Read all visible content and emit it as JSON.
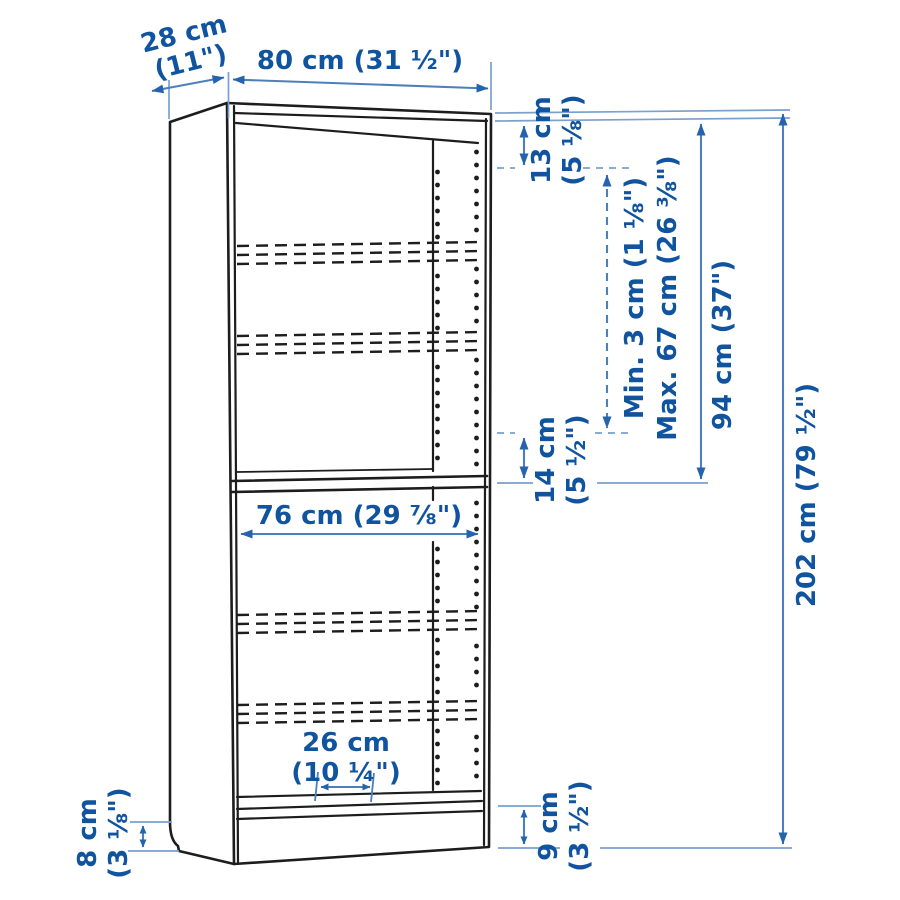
{
  "colors": {
    "dim_text": "#10549f",
    "dim_line": "#4d7fba",
    "dim_arrow": "#2563ac",
    "leader": "#7aa0cd",
    "outline": "#1d1d1d",
    "background": "#ffffff"
  },
  "dims": {
    "depth": {
      "l1": "28 cm",
      "l2": "(11\")"
    },
    "width": {
      "l1": "80 cm (31 ½\")"
    },
    "top_offset": {
      "l1": "13 cm",
      "l2": "(5 ⅛\")"
    },
    "shelf_minmax": {
      "l1": "Min. 3 cm (1 ⅛\")",
      "l2": "Max. 67 cm (26 ⅜\")"
    },
    "upper_section": {
      "l1": "94 cm (37\")"
    },
    "height": {
      "l1": "202 cm (79 ½\")"
    },
    "inner_width": {
      "l1": "76 cm (29 ⅞\")"
    },
    "shelf_gap": {
      "l1": "14 cm",
      "l2": "(5 ½\")"
    },
    "bottom_depth": {
      "l1": "26 cm",
      "l2": "(10 ¼\")"
    },
    "plinth_left": {
      "l1": "8 cm",
      "l2": "(3 ⅛\")"
    },
    "plinth_right": {
      "l1": "9 cm",
      "l2": "(3 ½\")"
    }
  }
}
